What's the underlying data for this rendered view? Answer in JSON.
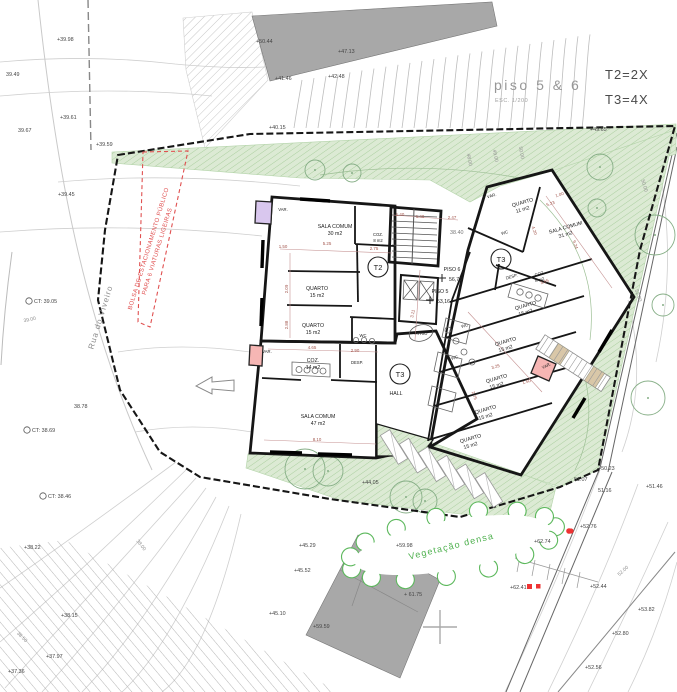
{
  "title_block": {
    "floor_label": "piso 5 & 6",
    "scale": "ESC. 1/200",
    "t2_count": "T2=2X",
    "t3_count": "T3=4X"
  },
  "annotations": {
    "street": "Rua do Viveiro",
    "parking_line1": "BOLSA DE ESTACIONAMENTO PÚBLICO",
    "parking_line2": "PARA 6 VIATURAS LIGEIRAS",
    "vegetation": "Vegetação densa"
  },
  "labels": {
    "var": "VAR.",
    "wc": "WC",
    "desp": "DESP.",
    "hall": "HALL",
    "atrio": "ÁTRIO"
  },
  "badges": {
    "t2": "T2",
    "t3": "T3"
  },
  "core": {
    "piso6": "PISO 6",
    "piso6_level": "56,75",
    "piso5": "PISO 5",
    "piso5_level": "53,16",
    "street_level": "38.40"
  },
  "rooms": {
    "t2_sala": {
      "name": "SALA COMUM",
      "area": "30 m2"
    },
    "t2_coz": {
      "name": "COZ.",
      "area": "8 m2"
    },
    "t2_q1": {
      "name": "QUARTO",
      "area": "15 m2"
    },
    "t2_q2": {
      "name": "QUARTO",
      "area": "15 m2"
    },
    "t3a_coz": {
      "name": "COZ.",
      "area": "14 m2"
    },
    "t3a_sala": {
      "name": "SALA COMUM",
      "area": "47 m2"
    },
    "t3b_q1": {
      "name": "QUARTO",
      "area": "11 m2"
    },
    "t3b_sala": {
      "name": "SALA COMUM",
      "area": "31 m2"
    },
    "t3b_coz": {
      "name": "COZ.",
      "area": "8 m2"
    },
    "w_q1": {
      "name": "QUARTO",
      "area": "15 m2"
    },
    "w_q2": {
      "name": "QUARTO",
      "area": "15 m2"
    },
    "w_q3": {
      "name": "QUARTO",
      "area": "15 m2"
    },
    "w_q4": {
      "name": "QUARTO",
      "area": "15 m2"
    },
    "w_q5": {
      "name": "QUARTO",
      "area": "15 m2"
    }
  },
  "markers": [
    {
      "t": "+39.98",
      "x": 57,
      "y": 41
    },
    {
      "t": "39.49",
      "x": 6,
      "y": 76
    },
    {
      "t": "+39.61",
      "x": 60,
      "y": 119
    },
    {
      "t": "39.67",
      "x": 18,
      "y": 132
    },
    {
      "t": "+39.59",
      "x": 96,
      "y": 146
    },
    {
      "t": "+39.45",
      "x": 58,
      "y": 196
    },
    {
      "t": "CT: 39.05",
      "x": 34,
      "y": 303,
      "c": 1
    },
    {
      "t": "38.78",
      "x": 74,
      "y": 408
    },
    {
      "t": "CT: 38.69",
      "x": 32,
      "y": 432,
      "c": 1
    },
    {
      "t": "CT: 38.46",
      "x": 48,
      "y": 498,
      "c": 1
    },
    {
      "t": "+38.22",
      "x": 24,
      "y": 549
    },
    {
      "t": "+38.15",
      "x": 61,
      "y": 617
    },
    {
      "t": "+37.97",
      "x": 46,
      "y": 658
    },
    {
      "t": "+37.36",
      "x": 8,
      "y": 673
    },
    {
      "t": "+50.44",
      "x": 256,
      "y": 43
    },
    {
      "t": "+47.13",
      "x": 338,
      "y": 53
    },
    {
      "t": "+42.48",
      "x": 328,
      "y": 78
    },
    {
      "t": "+41.46",
      "x": 275,
      "y": 80
    },
    {
      "t": "+40.15",
      "x": 269,
      "y": 129
    },
    {
      "t": "+49.65",
      "x": 590,
      "y": 131
    },
    {
      "t": "+44,05",
      "x": 362,
      "y": 484
    },
    {
      "t": "+45.29",
      "x": 299,
      "y": 547
    },
    {
      "t": "+45.52",
      "x": 294,
      "y": 572
    },
    {
      "t": "+45.10",
      "x": 269,
      "y": 615
    },
    {
      "t": "+59.59",
      "x": 313,
      "y": 628
    },
    {
      "t": "+59.98",
      "x": 396,
      "y": 547
    },
    {
      "t": "+ 61.75",
      "x": 404,
      "y": 596
    },
    {
      "t": "+62.41",
      "x": 510,
      "y": 589,
      "sq": 1
    },
    {
      "t": "+62.74",
      "x": 534,
      "y": 543
    },
    {
      "t": "+50.23",
      "x": 598,
      "y": 470
    },
    {
      "t": "51.07",
      "x": 574,
      "y": 481
    },
    {
      "t": "51.16",
      "x": 598,
      "y": 492
    },
    {
      "t": "+51.46",
      "x": 646,
      "y": 488
    },
    {
      "t": "+52.76",
      "x": 580,
      "y": 528,
      "dot": 1
    },
    {
      "t": "+52.44",
      "x": 590,
      "y": 588
    },
    {
      "t": "+53.82",
      "x": 638,
      "y": 611
    },
    {
      "t": "+52.80",
      "x": 612,
      "y": 635
    },
    {
      "t": "+52.56",
      "x": 585,
      "y": 669
    }
  ],
  "contour_labels": [
    {
      "t": "48.00",
      "x": 468,
      "y": 160,
      "rot": 80
    },
    {
      "t": "49.00",
      "x": 494,
      "y": 156,
      "rot": 80
    },
    {
      "t": "50.00",
      "x": 520,
      "y": 153,
      "rot": 80
    },
    {
      "t": "50.00",
      "x": 643,
      "y": 186,
      "rot": 74
    },
    {
      "t": "52.00",
      "x": 637,
      "y": 296,
      "rot": 70
    },
    {
      "t": "52.00",
      "x": 624,
      "y": 572,
      "rot": -42
    },
    {
      "t": "39.00",
      "x": 30,
      "y": 321,
      "rot": -12
    },
    {
      "t": "38.00",
      "x": 140,
      "y": 546,
      "rot": 52
    },
    {
      "t": "38.50",
      "x": 21,
      "y": 638,
      "rot": 45
    }
  ],
  "dims": [
    {
      "t": "1.50",
      "x": 283,
      "y": 248
    },
    {
      "t": "5.25",
      "x": 327,
      "y": 245
    },
    {
      "t": "2.75",
      "x": 374,
      "y": 250
    },
    {
      "t": "2.09",
      "x": 288,
      "y": 289,
      "rot": -90
    },
    {
      "t": "2.88",
      "x": 288,
      "y": 325,
      "rot": -90
    },
    {
      "t": "1.40",
      "x": 400,
      "y": 216
    },
    {
      "t": "1.40",
      "x": 420,
      "y": 218
    },
    {
      "t": "2.47",
      "x": 452,
      "y": 219
    },
    {
      "t": "3.11",
      "x": 414,
      "y": 314,
      "rot": -78
    },
    {
      "t": "4.65",
      "x": 312,
      "y": 349
    },
    {
      "t": "2.90",
      "x": 355,
      "y": 352
    },
    {
      "t": "8.10",
      "x": 317,
      "y": 441
    },
    {
      "t": "5.23",
      "x": 551,
      "y": 205,
      "rot": -18
    },
    {
      "t": "1.00",
      "x": 560,
      "y": 196,
      "rot": -18
    },
    {
      "t": "4.20",
      "x": 533,
      "y": 231,
      "rot": 72
    },
    {
      "t": "9.24",
      "x": 574,
      "y": 245,
      "rot": 72
    },
    {
      "t": "3.65",
      "x": 545,
      "y": 283,
      "rot": -18
    },
    {
      "t": "3.25",
      "x": 496,
      "y": 368,
      "rot": -17
    },
    {
      "t": "1.50",
      "x": 527,
      "y": 383,
      "rot": -17
    },
    {
      "t": "2.75",
      "x": 473,
      "y": 396,
      "rot": 72
    }
  ],
  "colors": {
    "t2_fill": "#d9c7ee",
    "t3_fill": "#f6b6b4",
    "green_fill": "#dcead4",
    "green_hatch": "#abcf9f",
    "gray_building": "#a8a8a8",
    "red_note": "#e05050",
    "veg_text": "#4db04d"
  }
}
